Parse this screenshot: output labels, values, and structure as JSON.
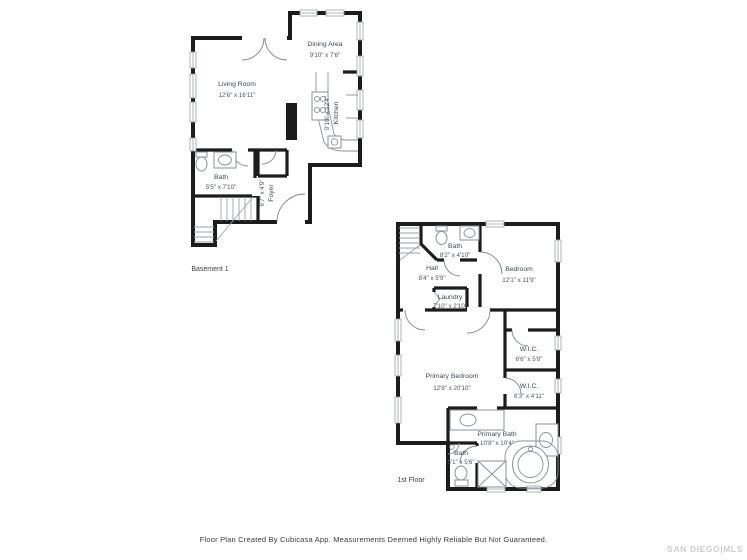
{
  "page": {
    "disclaimer": "Floor Plan Created By Cubicasa App. Measurements Deemed Highly Reliable But Not Guaranteed.",
    "watermark": "SAN DIEGO|MLS"
  },
  "basement": {
    "floor_label": "Basement 1",
    "rooms": {
      "living_room": {
        "name": "Living Room",
        "dims": "12'6\" x 16'11\""
      },
      "dining_area": {
        "name": "Dining Area",
        "dims": "9'10\" x 7'6\""
      },
      "kitchen": {
        "name": "Kitchen",
        "dims": "9'10\" x 12'4\""
      },
      "bath": {
        "name": "Bath",
        "dims": "5'5\" x 7'10\""
      },
      "foyer": {
        "name": "Foyer",
        "dims": "6'7\" x 4'9\""
      }
    }
  },
  "first_floor": {
    "floor_label": "1st Floor",
    "rooms": {
      "bath": {
        "name": "Bath",
        "dims": "8'2\" x 4'10\""
      },
      "hall": {
        "name": "Hall",
        "dims": "8'4\" x 5'9\""
      },
      "bedroom": {
        "name": "Bedroom",
        "dims": "12'1\" x 11'9\""
      },
      "laundry": {
        "name": "Laundry",
        "dims": "7'10\" x 2'10\""
      },
      "primary_bedroom": {
        "name": "Primary Bedroom",
        "dims": "12'8\" x 20'10\""
      },
      "wic_1": {
        "name": "W.I.C.",
        "dims": "6'6\" x 5'8\""
      },
      "wic_2": {
        "name": "W.I.C.",
        "dims": "6'3\" x 4'11\""
      },
      "primary_bath": {
        "name": "Primary Bath",
        "dims": "10'8\" x 10'4\""
      },
      "bath_2": {
        "name": "Bath",
        "dims": "5'1\" x 5'6\""
      }
    }
  },
  "colors": {
    "wall": "#1c1c1c",
    "line": "#9aa2a8",
    "text": "#3d4852",
    "watermark": "#c9cdd0"
  }
}
